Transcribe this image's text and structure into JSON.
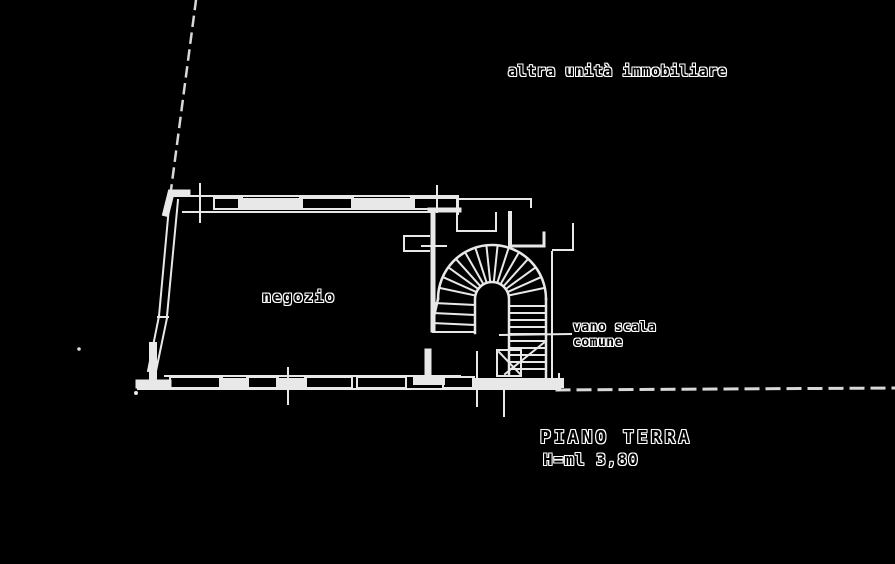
{
  "drawing": {
    "type": "cadastral-floor-plan",
    "colors": {
      "background": "#000000",
      "wall_line": "#e8e8e8",
      "dashed_line": "#d8d8d8",
      "label_text": "#000000",
      "label_halo": "#ffffff"
    },
    "labels": {
      "other_unit": "altra unità immobiliare",
      "room": "negozio",
      "stairwell_line1": "vano scala",
      "stairwell_line2": "comune",
      "floor_title": "PIANO TERRA",
      "floor_height": "H=ml 3,80"
    }
  }
}
